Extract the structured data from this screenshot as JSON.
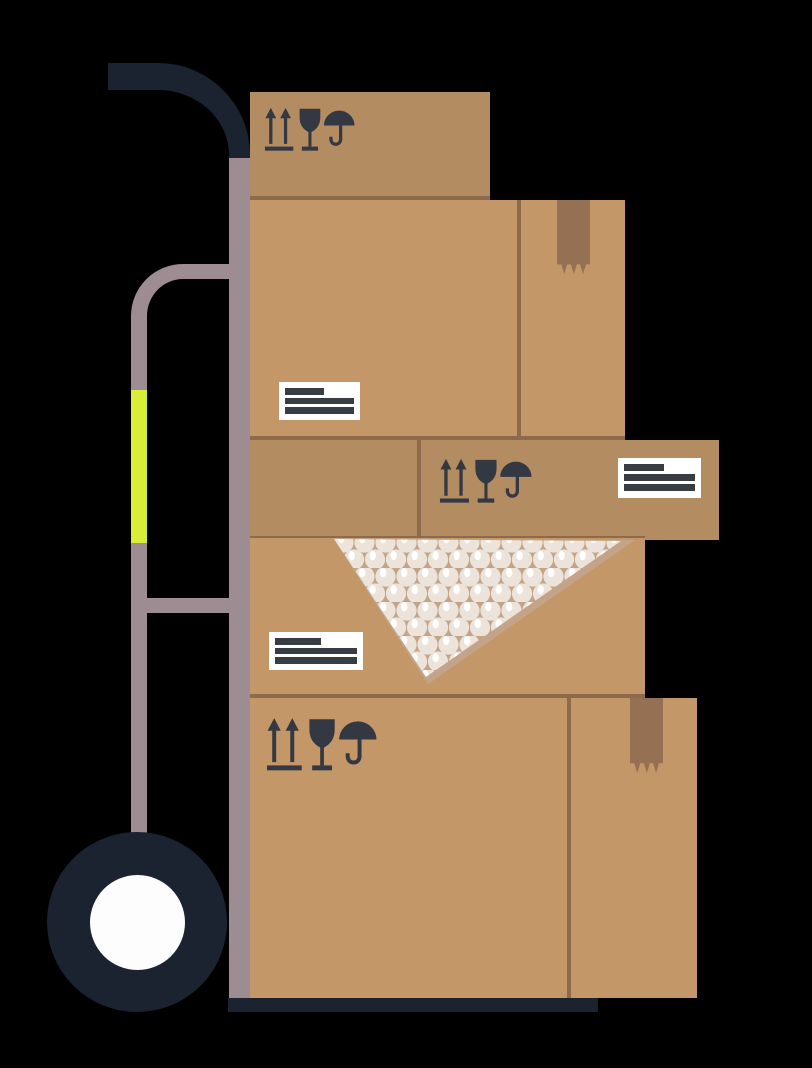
{
  "scene": {
    "description": "Flat illustration of a hand truck (dolly) stacked with five cardboard moving boxes",
    "background": "#000000"
  },
  "colors": {
    "bg": "#000000",
    "frame-dark": "#1b2330",
    "frame-mauve": "#9d8d92",
    "grip-yellow": "#d9ee39",
    "wheel-hub": "#fdfdfd",
    "box-tan": "#c39768",
    "box-tan-dark": "#b48c62",
    "box-edge": "#8d6a4b",
    "tape": "#957053",
    "icon-dark": "#333842",
    "label-bg": "#ffffff",
    "label-line": "#383c43",
    "bubble-bg": "#c4a488",
    "bubble": "#ece4da",
    "bubble-highlight": "#ffffff"
  },
  "handtruck": {
    "parts": [
      "curved-top-handle",
      "main-frame-pole",
      "secondary-handle",
      "yellow-grip",
      "crossbar",
      "wheel",
      "white-hub",
      "base-plate"
    ]
  },
  "boxes": [
    {
      "id": "box-1",
      "position": "top",
      "icons": [
        "this-way-up-icon",
        "fragile-glass-icon",
        "keep-dry-umbrella-icon"
      ],
      "label_lines": 0,
      "tape": false,
      "bubble_wrap": false
    },
    {
      "id": "box-2",
      "position": "upper-large",
      "icons": [],
      "label_lines": 3,
      "tape": true,
      "bubble_wrap": false
    },
    {
      "id": "box-3",
      "position": "middle-wide",
      "icons": [
        "this-way-up-icon",
        "fragile-glass-icon",
        "keep-dry-umbrella-icon"
      ],
      "label_lines": 3,
      "tape": false,
      "bubble_wrap": false
    },
    {
      "id": "box-4",
      "position": "lower-middle",
      "icons": [],
      "label_lines": 3,
      "tape": false,
      "bubble_wrap": true
    },
    {
      "id": "box-5",
      "position": "bottom-large",
      "icons": [
        "this-way-up-icon",
        "fragile-glass-icon",
        "keep-dry-umbrella-icon"
      ],
      "label_lines": 3,
      "tape": true,
      "bubble_wrap": false
    }
  ]
}
